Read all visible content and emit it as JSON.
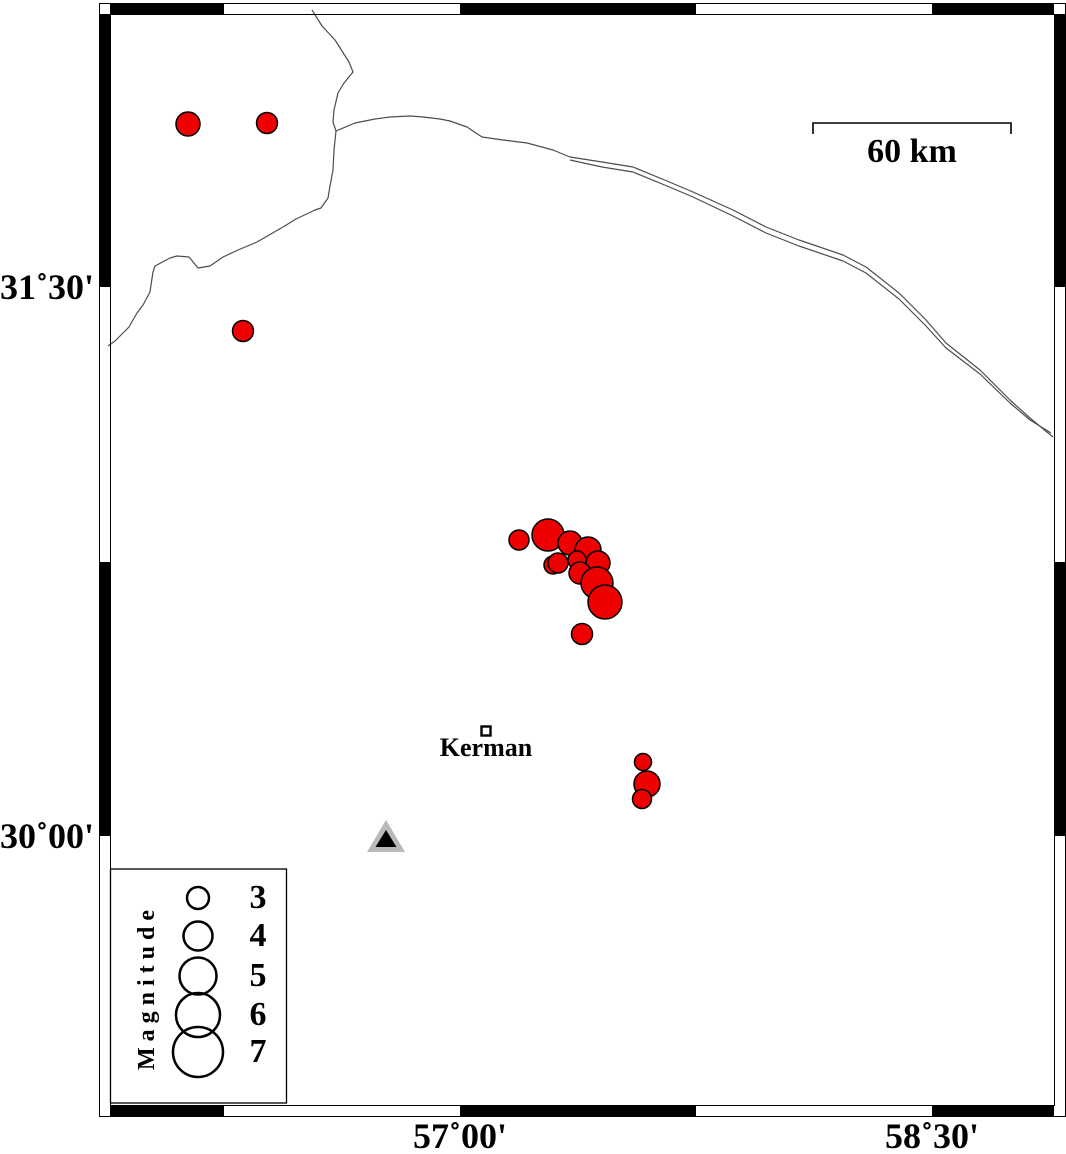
{
  "colors": {
    "background": "#ffffff",
    "earthquake_fill": "#ee0000",
    "marker_stroke": "#000000",
    "border_line": "#4d4d4d",
    "station_gray": "#b9b9b9",
    "frame_black": "#000000"
  },
  "chart_data": {
    "type": "scatter",
    "title": "",
    "subtitle": "Epicenter map of earthquakes near Kerman, Iran, with magnitude-scaled symbols",
    "axis": {
      "lon_ticks": [
        {
          "label": "57˚00'",
          "x": 460,
          "lon_deg": 57.0
        },
        {
          "label": "58˚30'",
          "x": 932,
          "lon_deg": 58.5
        }
      ],
      "lat_ticks": [
        {
          "label": "31˚30'",
          "y": 287,
          "lat_deg": 31.5
        },
        {
          "label": "30˚00'",
          "y": 836,
          "lat_deg": 30.0
        }
      ],
      "px_per_deg_lon": 314.7,
      "px_per_deg_lat": 364.7,
      "grid": "off"
    },
    "frame": {
      "outer": {
        "x": 99.5,
        "y": 3.5,
        "w": 966,
        "h": 1113
      },
      "inner": {
        "x": 110.5,
        "y": 14.5,
        "w": 944,
        "h": 1091
      },
      "top_black_segments": [
        [
          110,
          224
        ],
        [
          460,
          696
        ],
        [
          932,
          1054
        ]
      ],
      "bottom_black_segments": [
        [
          110,
          224
        ],
        [
          460,
          696
        ],
        [
          932,
          1054
        ]
      ],
      "left_black_segments": [
        [
          14,
          287
        ],
        [
          562,
          836
        ]
      ],
      "right_black_segments": [
        [
          14,
          287
        ],
        [
          562,
          836
        ]
      ]
    },
    "scale_bar": {
      "label": "60 km",
      "x1": 813,
      "x2": 1011,
      "y": 123,
      "tick_drop": 11
    },
    "city": {
      "name": "Kerman",
      "x": 486,
      "y": 731,
      "square_size": 9
    },
    "station": {
      "outer_points": "386,820 367,852 405,852",
      "inner_points": "386,830 375.5,847 396.5,847"
    },
    "earthquakes": [
      {
        "x": 188,
        "y": 124,
        "r": 12,
        "lon": 56.14,
        "lat": 31.95,
        "mag": 3.3
      },
      {
        "x": 267,
        "y": 123,
        "r": 10.5,
        "lon": 56.39,
        "lat": 31.95,
        "mag": 2.9
      },
      {
        "x": 243,
        "y": 331,
        "r": 10.5,
        "lon": 56.31,
        "lat": 31.38,
        "mag": 2.9
      },
      {
        "x": 519,
        "y": 540,
        "r": 10,
        "lon": 57.19,
        "lat": 30.81,
        "mag": 2.7
      },
      {
        "x": 548,
        "y": 535,
        "r": 16,
        "lon": 57.28,
        "lat": 30.82,
        "mag": 4.4
      },
      {
        "x": 570,
        "y": 543,
        "r": 12,
        "lon": 57.35,
        "lat": 30.8,
        "mag": 3.3
      },
      {
        "x": 588,
        "y": 550,
        "r": 13,
        "lon": 57.41,
        "lat": 30.78,
        "mag": 3.6
      },
      {
        "x": 553,
        "y": 565,
        "r": 9,
        "lon": 57.3,
        "lat": 30.74,
        "mag": 2.4
      },
      {
        "x": 558,
        "y": 563,
        "r": 10,
        "lon": 57.31,
        "lat": 30.74,
        "mag": 2.7
      },
      {
        "x": 577,
        "y": 560,
        "r": 9,
        "lon": 57.37,
        "lat": 30.75,
        "mag": 2.4
      },
      {
        "x": 598,
        "y": 563,
        "r": 12,
        "lon": 57.44,
        "lat": 30.74,
        "mag": 3.3
      },
      {
        "x": 580,
        "y": 573,
        "r": 11,
        "lon": 57.38,
        "lat": 30.72,
        "mag": 3.0
      },
      {
        "x": 597,
        "y": 583,
        "r": 16,
        "lon": 57.44,
        "lat": 30.69,
        "mag": 4.4
      },
      {
        "x": 605,
        "y": 602,
        "r": 17,
        "lon": 57.46,
        "lat": 30.64,
        "mag": 4.7
      },
      {
        "x": 582,
        "y": 634,
        "r": 10.5,
        "lon": 57.39,
        "lat": 30.55,
        "mag": 2.9
      },
      {
        "x": 643,
        "y": 762,
        "r": 8.5,
        "lon": 57.58,
        "lat": 30.2,
        "mag": 2.3
      },
      {
        "x": 647,
        "y": 784,
        "r": 13,
        "lon": 57.59,
        "lat": 30.14,
        "mag": 3.6
      },
      {
        "x": 642,
        "y": 799,
        "r": 9.5,
        "lon": 57.58,
        "lat": 30.1,
        "mag": 2.6
      }
    ],
    "border_paths": [
      [
        [
          312,
          10
        ],
        [
          322,
          26
        ],
        [
          335,
          40
        ],
        [
          349,
          62
        ],
        [
          353,
          72
        ],
        [
          344,
          83
        ],
        [
          338,
          93
        ],
        [
          334,
          110
        ],
        [
          333,
          122
        ],
        [
          336,
          131
        ],
        [
          334,
          150
        ],
        [
          333,
          170
        ],
        [
          330,
          186
        ],
        [
          328,
          198
        ],
        [
          321,
          208
        ],
        [
          315,
          210
        ],
        [
          296,
          219
        ],
        [
          283,
          227
        ],
        [
          257,
          242
        ],
        [
          238,
          250
        ],
        [
          223,
          257
        ],
        [
          210,
          266
        ],
        [
          198,
          268
        ],
        [
          189,
          257
        ],
        [
          177,
          256
        ],
        [
          170,
          258
        ],
        [
          155,
          266
        ],
        [
          153,
          272
        ],
        [
          151,
          285
        ],
        [
          150,
          292
        ],
        [
          143,
          305
        ],
        [
          137,
          313
        ],
        [
          129,
          327
        ],
        [
          123,
          333
        ],
        [
          115,
          341
        ],
        [
          108,
          346
        ]
      ],
      [
        [
          336,
          131
        ],
        [
          355,
          123
        ],
        [
          375,
          119
        ],
        [
          390,
          117
        ],
        [
          410,
          116
        ],
        [
          423,
          117
        ],
        [
          440,
          119
        ],
        [
          450,
          121
        ],
        [
          467,
          127
        ],
        [
          482,
          137
        ],
        [
          503,
          140
        ],
        [
          527,
          143
        ],
        [
          553,
          150
        ],
        [
          570,
          157
        ],
        [
          602,
          162
        ],
        [
          633,
          167
        ],
        [
          667,
          181
        ],
        [
          693,
          192
        ],
        [
          733,
          210
        ],
        [
          766,
          227
        ],
        [
          799,
          240
        ],
        [
          843,
          255
        ],
        [
          866,
          267
        ],
        [
          899,
          293
        ],
        [
          926,
          320
        ],
        [
          946,
          343
        ],
        [
          980,
          370
        ],
        [
          1010,
          400
        ],
        [
          1030,
          418
        ],
        [
          1053,
          437
        ]
      ],
      [
        [
          570,
          160
        ],
        [
          602,
          167
        ],
        [
          633,
          172
        ],
        [
          667,
          186
        ],
        [
          693,
          197
        ],
        [
          733,
          216
        ],
        [
          766,
          233
        ],
        [
          799,
          246
        ],
        [
          843,
          261
        ],
        [
          866,
          273
        ],
        [
          899,
          299
        ],
        [
          926,
          326
        ],
        [
          946,
          348
        ],
        [
          980,
          374
        ],
        [
          1010,
          403
        ],
        [
          1030,
          420
        ],
        [
          1051,
          433
        ]
      ]
    ],
    "legend": {
      "title": "Magnitude",
      "box": {
        "x": 110.5,
        "y": 869,
        "w": 176,
        "h": 234
      },
      "circle_cx": 198,
      "label_x": 258,
      "items": [
        {
          "label": "3",
          "cy": 898,
          "r": 11
        },
        {
          "label": "4",
          "cy": 936,
          "r": 14.5
        },
        {
          "label": "5",
          "cy": 976,
          "r": 18.5
        },
        {
          "label": "6",
          "cy": 1015,
          "r": 22
        },
        {
          "label": "7",
          "cy": 1052,
          "r": 25
        }
      ]
    }
  }
}
